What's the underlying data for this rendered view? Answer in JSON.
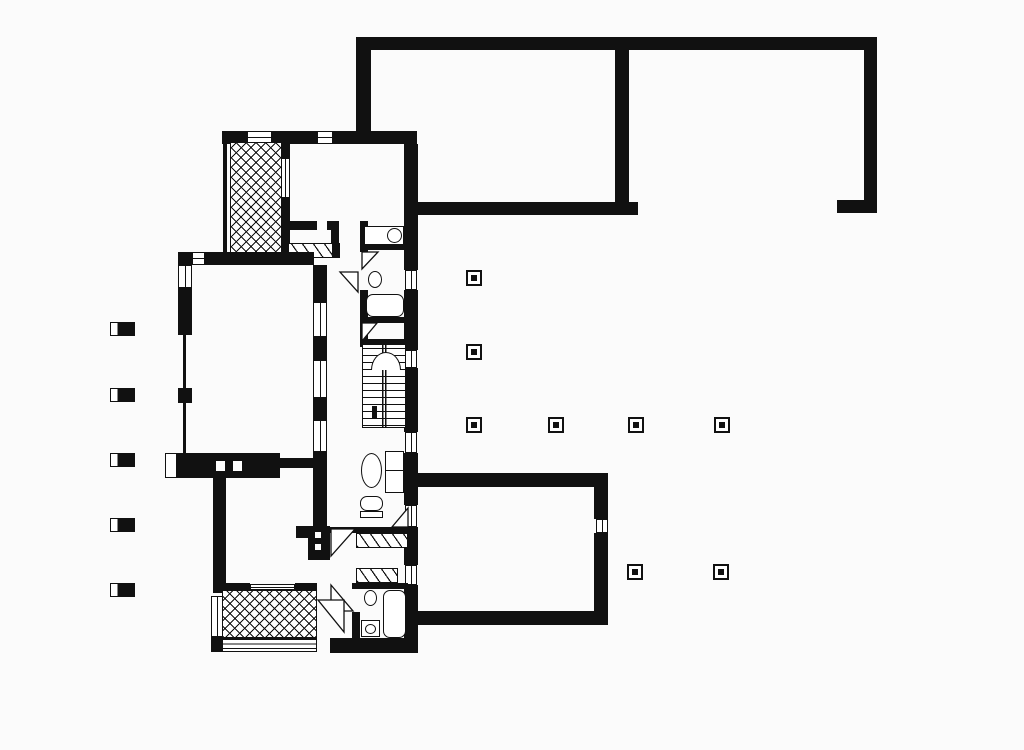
{
  "meta": {
    "kind": "architectural-floor-plan",
    "ink_color": "#111111",
    "paper_color": "#fbfbfb",
    "canvas": {
      "w": 1024,
      "h": 750
    }
  },
  "plan": {
    "elements": [
      {
        "name": "courtyard-top-wall",
        "t": "wall",
        "x": 356,
        "y": 37,
        "w": 521,
        "h": 13
      },
      {
        "name": "courtyard-left-wall",
        "t": "wall",
        "x": 356,
        "y": 44,
        "w": 15,
        "h": 99
      },
      {
        "name": "courtyard-divider-wall",
        "t": "wall",
        "x": 615,
        "y": 50,
        "w": 14,
        "h": 153
      },
      {
        "name": "courtyard-bottom-wall",
        "t": "wall",
        "x": 412,
        "y": 202,
        "w": 226,
        "h": 13
      },
      {
        "name": "courtyard-right-wall",
        "t": "wall",
        "x": 864,
        "y": 44,
        "w": 13,
        "h": 169
      },
      {
        "name": "courtyard-right-wall-foot",
        "t": "wall",
        "x": 837,
        "y": 200,
        "w": 40,
        "h": 13
      },
      {
        "name": "house-top-wall-left",
        "t": "wall",
        "x": 222,
        "y": 131,
        "w": 25,
        "h": 13
      },
      {
        "name": "window-top-terrace",
        "t": "window",
        "x": 247,
        "y": 131,
        "w": 25,
        "h": 13
      },
      {
        "name": "house-top-wall-mid",
        "t": "wall",
        "x": 272,
        "y": 131,
        "w": 45,
        "h": 13
      },
      {
        "name": "window-bedroom-north",
        "t": "window",
        "x": 317,
        "y": 131,
        "w": 16,
        "h": 13
      },
      {
        "name": "house-top-wall-right",
        "t": "wall",
        "x": 333,
        "y": 131,
        "w": 84,
        "h": 13
      },
      {
        "name": "east-wall-1",
        "t": "wall",
        "x": 404,
        "y": 144,
        "w": 14,
        "h": 126
      },
      {
        "name": "east-window-1",
        "t": "window",
        "x": 405,
        "y": 270,
        "w": 12,
        "h": 20
      },
      {
        "name": "east-wall-2",
        "t": "wall",
        "x": 404,
        "y": 290,
        "w": 14,
        "h": 60
      },
      {
        "name": "east-window-2",
        "t": "window",
        "x": 405,
        "y": 350,
        "w": 12,
        "h": 18
      },
      {
        "name": "east-wall-3",
        "t": "wall",
        "x": 404,
        "y": 368,
        "w": 14,
        "h": 64
      },
      {
        "name": "east-window-3",
        "t": "window",
        "x": 405,
        "y": 432,
        "w": 12,
        "h": 21
      },
      {
        "name": "east-wall-4",
        "t": "wall",
        "x": 404,
        "y": 453,
        "w": 14,
        "h": 52
      },
      {
        "name": "east-window-4",
        "t": "window",
        "x": 405,
        "y": 505,
        "w": 12,
        "h": 22
      },
      {
        "name": "east-wall-5",
        "t": "wall",
        "x": 404,
        "y": 527,
        "w": 14,
        "h": 38
      },
      {
        "name": "east-window-5",
        "t": "window",
        "x": 405,
        "y": 565,
        "w": 12,
        "h": 20
      },
      {
        "name": "east-wall-6",
        "t": "wall",
        "x": 404,
        "y": 585,
        "w": 14,
        "h": 68
      },
      {
        "name": "upper-terrace-west-glazing",
        "t": "glazing",
        "x": 223,
        "y": 144,
        "w": 4,
        "h": 112
      },
      {
        "name": "upper-terrace-crosshatch",
        "t": "crosshatch",
        "x": 230,
        "y": 142,
        "w": 52,
        "h": 116
      },
      {
        "name": "upper-terrace-east-wall-a",
        "t": "wall",
        "x": 281,
        "y": 144,
        "w": 9,
        "h": 14
      },
      {
        "name": "upper-terrace-east-window",
        "t": "window",
        "x": 281,
        "y": 158,
        "w": 9,
        "h": 40
      },
      {
        "name": "upper-terrace-east-wall-b",
        "t": "wall",
        "x": 281,
        "y": 198,
        "w": 9,
        "h": 60
      },
      {
        "name": "bedroom-south-wall-a",
        "t": "wall",
        "x": 283,
        "y": 221,
        "w": 34,
        "h": 9
      },
      {
        "name": "bedroom-south-wall-b",
        "t": "wall",
        "x": 327,
        "y": 221,
        "w": 12,
        "h": 9
      },
      {
        "name": "hall-stub-wall",
        "t": "wall",
        "x": 331,
        "y": 230,
        "w": 8,
        "h": 28
      },
      {
        "name": "bedroom-closet-hatch",
        "t": "hatch",
        "x": 288,
        "y": 243,
        "w": 45,
        "h": 15
      },
      {
        "name": "closet-side-wall",
        "t": "wall",
        "x": 333,
        "y": 243,
        "w": 7,
        "h": 15
      },
      {
        "name": "living-north-wall-corner",
        "t": "wall",
        "x": 178,
        "y": 252,
        "w": 14,
        "h": 13
      },
      {
        "name": "living-north-window",
        "t": "window",
        "x": 192,
        "y": 252,
        "w": 13,
        "h": 13
      },
      {
        "name": "living-north-wall",
        "t": "wall",
        "x": 205,
        "y": 252,
        "w": 109,
        "h": 13
      },
      {
        "name": "west-window-1",
        "t": "window",
        "x": 178,
        "y": 265,
        "w": 14,
        "h": 23
      },
      {
        "name": "west-wall-1",
        "t": "wall",
        "x": 178,
        "y": 288,
        "w": 14,
        "h": 47
      },
      {
        "name": "west-glazing-1",
        "t": "glazing",
        "x": 183,
        "y": 335,
        "w": 3,
        "h": 53
      },
      {
        "name": "west-pier",
        "t": "wall",
        "x": 178,
        "y": 388,
        "w": 14,
        "h": 15
      },
      {
        "name": "west-glazing-2",
        "t": "glazing",
        "x": 183,
        "y": 403,
        "w": 3,
        "h": 50
      },
      {
        "name": "living-east-wall-1",
        "t": "wall",
        "x": 313,
        "y": 265,
        "w": 14,
        "h": 37
      },
      {
        "name": "living-east-window-1",
        "t": "window",
        "x": 313,
        "y": 302,
        "w": 14,
        "h": 35
      },
      {
        "name": "living-east-wall-2",
        "t": "wall",
        "x": 313,
        "y": 337,
        "w": 14,
        "h": 23
      },
      {
        "name": "living-east-window-2",
        "t": "window",
        "x": 313,
        "y": 360,
        "w": 14,
        "h": 38
      },
      {
        "name": "living-east-wall-3",
        "t": "wall",
        "x": 313,
        "y": 398,
        "w": 14,
        "h": 22
      },
      {
        "name": "living-east-window-3",
        "t": "window",
        "x": 313,
        "y": 420,
        "w": 14,
        "h": 32
      },
      {
        "name": "living-east-wall-4",
        "t": "wall",
        "x": 313,
        "y": 452,
        "w": 14,
        "h": 76
      },
      {
        "name": "pier-stub",
        "t": "wall",
        "x": 296,
        "y": 526,
        "w": 16,
        "h": 12
      },
      {
        "name": "pier-with-sockets",
        "t": "wall",
        "x": 308,
        "y": 526,
        "w": 22,
        "h": 34
      },
      {
        "name": "pier-socket-1",
        "t": "dotw",
        "x": 315,
        "y": 532,
        "w": 6,
        "h": 6
      },
      {
        "name": "pier-socket-2",
        "t": "dotw",
        "x": 315,
        "y": 544,
        "w": 6,
        "h": 6
      },
      {
        "name": "fireplace-cap",
        "t": "wallcap",
        "x": 165,
        "y": 453,
        "w": 12,
        "h": 25
      },
      {
        "name": "fireplace-mass",
        "t": "wall",
        "x": 177,
        "y": 453,
        "w": 103,
        "h": 25
      },
      {
        "name": "fireplace-flue-1",
        "t": "dotw",
        "x": 216,
        "y": 461,
        "w": 9,
        "h": 10
      },
      {
        "name": "fireplace-flue-2",
        "t": "dotw",
        "x": 233,
        "y": 461,
        "w": 9,
        "h": 10
      },
      {
        "name": "fireplace-link-wall",
        "t": "wall",
        "x": 280,
        "y": 458,
        "w": 33,
        "h": 10
      },
      {
        "name": "southwest-room-west-wall",
        "t": "wall",
        "x": 213,
        "y": 478,
        "w": 13,
        "h": 115
      },
      {
        "name": "lower-terrace-north-wall-a",
        "t": "wall",
        "x": 220,
        "y": 583,
        "w": 30,
        "h": 7
      },
      {
        "name": "lower-terrace-north-glazing",
        "t": "window",
        "x": 250,
        "y": 584,
        "w": 45,
        "h": 6
      },
      {
        "name": "lower-terrace-north-wall-b",
        "t": "wall",
        "x": 295,
        "y": 583,
        "w": 22,
        "h": 7
      },
      {
        "name": "lower-terrace-crosshatch",
        "t": "crosshatch",
        "x": 222,
        "y": 590,
        "w": 95,
        "h": 48
      },
      {
        "name": "lower-terrace-west-window",
        "t": "window",
        "x": 211,
        "y": 596,
        "w": 12,
        "h": 41
      },
      {
        "name": "lower-terrace-steps",
        "t": "steps",
        "x": 222,
        "y": 638,
        "w": 95,
        "h": 14
      },
      {
        "name": "lower-terrace-west-corner",
        "t": "wall",
        "x": 211,
        "y": 637,
        "w": 12,
        "h": 15
      },
      {
        "name": "house-south-wall",
        "t": "wall",
        "x": 330,
        "y": 638,
        "w": 88,
        "h": 15
      },
      {
        "name": "bath1-west-wall-a",
        "t": "wall",
        "x": 360,
        "y": 221,
        "w": 8,
        "h": 31
      },
      {
        "name": "bath1-west-wall-b",
        "t": "wall",
        "x": 360,
        "y": 290,
        "w": 8,
        "h": 57
      },
      {
        "name": "wc1-divider-wall",
        "t": "wall",
        "x": 368,
        "y": 245,
        "w": 36,
        "h": 5
      },
      {
        "name": "wc1-cistern",
        "t": "rect-outline",
        "x": 364,
        "y": 226,
        "w": 40,
        "h": 19
      },
      {
        "name": "wc1-bowl",
        "t": "ellipse",
        "x": 387,
        "y": 228,
        "w": 15,
        "h": 15
      },
      {
        "name": "wc1-door",
        "t": "door",
        "x": 362,
        "y": 252,
        "w": 16,
        "h": 17,
        "pts": "tl,bl,tr"
      },
      {
        "name": "bath1-door",
        "t": "door",
        "x": 340,
        "y": 272,
        "w": 18,
        "h": 20,
        "pts": "tr,br,tl"
      },
      {
        "name": "bath1-sink",
        "t": "ellipse",
        "x": 368,
        "y": 271,
        "w": 14,
        "h": 17
      },
      {
        "name": "bath1-tub",
        "t": "roundrect",
        "x": 366,
        "y": 294,
        "w": 38,
        "h": 23
      },
      {
        "name": "bath1-south-wall",
        "t": "wall",
        "x": 360,
        "y": 317,
        "w": 44,
        "h": 6
      },
      {
        "name": "vestibule-door",
        "t": "door",
        "x": 362,
        "y": 323,
        "w": 15,
        "h": 18,
        "pts": "tl,bl,tr"
      },
      {
        "name": "stairs-north-wall",
        "t": "wall",
        "x": 362,
        "y": 339,
        "w": 42,
        "h": 6
      },
      {
        "name": "staircase",
        "t": "stairs",
        "x": 362,
        "y": 345,
        "w": 44,
        "h": 83
      },
      {
        "name": "stairs-arc",
        "t": "arc",
        "x": 371,
        "y": 352,
        "w": 30,
        "h": 18
      },
      {
        "name": "stairs-newel",
        "t": "wall",
        "x": 372,
        "y": 406,
        "w": 5,
        "h": 13
      },
      {
        "name": "coffee-table",
        "t": "ellipse",
        "x": 361,
        "y": 453,
        "w": 21,
        "h": 35
      },
      {
        "name": "sofa",
        "t": "rect2",
        "x": 385,
        "y": 451,
        "w": 19,
        "h": 42
      },
      {
        "name": "armchair-seat",
        "t": "roundrect",
        "x": 360,
        "y": 496,
        "w": 23,
        "h": 15
      },
      {
        "name": "armchair-base",
        "t": "rect-outline",
        "x": 360,
        "y": 511,
        "w": 23,
        "h": 7
      },
      {
        "name": "entry-door",
        "t": "door",
        "x": 392,
        "y": 508,
        "w": 16,
        "h": 19,
        "pts": "br,tr,bl"
      },
      {
        "name": "hall-south-wall",
        "t": "wall",
        "x": 330,
        "y": 527,
        "w": 80,
        "h": 6
      },
      {
        "name": "closet-1-hatch",
        "t": "hatch",
        "x": 356,
        "y": 533,
        "w": 52,
        "h": 15
      },
      {
        "name": "sw-room-door",
        "t": "door",
        "x": 331,
        "y": 529,
        "w": 24,
        "h": 27,
        "pts": "tl,tr,bl"
      },
      {
        "name": "closet-2-hatch",
        "t": "hatch",
        "x": 356,
        "y": 568,
        "w": 42,
        "h": 15
      },
      {
        "name": "bath2-north-wall",
        "t": "wall",
        "x": 352,
        "y": 583,
        "w": 56,
        "h": 6
      },
      {
        "name": "bath2-door",
        "t": "door",
        "x": 331,
        "y": 585,
        "w": 22,
        "h": 26,
        "pts": "bl,tl,br"
      },
      {
        "name": "bath2-west-wall",
        "t": "wall",
        "x": 352,
        "y": 612,
        "w": 8,
        "h": 26
      },
      {
        "name": "bath2-sink",
        "t": "ellipse",
        "x": 364,
        "y": 590,
        "w": 13,
        "h": 16
      },
      {
        "name": "bath2-tub",
        "t": "roundrect",
        "x": 383,
        "y": 590,
        "w": 23,
        "h": 48
      },
      {
        "name": "wc2-body",
        "t": "rect-outline",
        "x": 361,
        "y": 620,
        "w": 19,
        "h": 17
      },
      {
        "name": "wc2-bowl",
        "t": "ellipse",
        "x": 365,
        "y": 624,
        "w": 11,
        "h": 10
      },
      {
        "name": "lower-terrace-door",
        "t": "door",
        "x": 318,
        "y": 600,
        "w": 26,
        "h": 32,
        "pts": "tr,br,tl"
      },
      {
        "name": "se-room-north-wall",
        "t": "wall",
        "x": 412,
        "y": 473,
        "w": 196,
        "h": 14
      },
      {
        "name": "se-room-east-wall-a",
        "t": "wall",
        "x": 594,
        "y": 487,
        "w": 14,
        "h": 32
      },
      {
        "name": "se-room-east-window",
        "t": "window",
        "x": 596,
        "y": 519,
        "w": 12,
        "h": 14
      },
      {
        "name": "se-room-east-wall-b",
        "t": "wall",
        "x": 594,
        "y": 533,
        "w": 14,
        "h": 78
      },
      {
        "name": "se-room-south-wall",
        "t": "wall",
        "x": 412,
        "y": 611,
        "w": 196,
        "h": 14
      },
      {
        "name": "pergola-column-west-1",
        "t": "colbar",
        "x": 110,
        "y": 322,
        "w": 25,
        "h": 14
      },
      {
        "name": "pergola-column-west-2",
        "t": "colbar",
        "x": 110,
        "y": 388,
        "w": 25,
        "h": 14
      },
      {
        "name": "pergola-column-west-3",
        "t": "colbar",
        "x": 110,
        "y": 453,
        "w": 25,
        "h": 14
      },
      {
        "name": "pergola-column-west-4",
        "t": "colbar",
        "x": 110,
        "y": 518,
        "w": 25,
        "h": 14
      },
      {
        "name": "pergola-column-west-5",
        "t": "colbar",
        "x": 110,
        "y": 583,
        "w": 25,
        "h": 14
      },
      {
        "name": "free-column-1",
        "t": "colsq",
        "x": 466,
        "y": 270,
        "w": 16,
        "h": 16
      },
      {
        "name": "free-column-2",
        "t": "colsq",
        "x": 466,
        "y": 344,
        "w": 16,
        "h": 16
      },
      {
        "name": "free-column-3",
        "t": "colsq",
        "x": 466,
        "y": 417,
        "w": 16,
        "h": 16
      },
      {
        "name": "free-column-4",
        "t": "colsq",
        "x": 548,
        "y": 417,
        "w": 16,
        "h": 16
      },
      {
        "name": "free-column-5",
        "t": "colsq",
        "x": 628,
        "y": 417,
        "w": 16,
        "h": 16
      },
      {
        "name": "free-column-6",
        "t": "colsq",
        "x": 714,
        "y": 417,
        "w": 16,
        "h": 16
      },
      {
        "name": "free-column-7",
        "t": "colsq",
        "x": 627,
        "y": 564,
        "w": 16,
        "h": 16
      },
      {
        "name": "free-column-8",
        "t": "colsq",
        "x": 713,
        "y": 564,
        "w": 16,
        "h": 16
      }
    ]
  }
}
